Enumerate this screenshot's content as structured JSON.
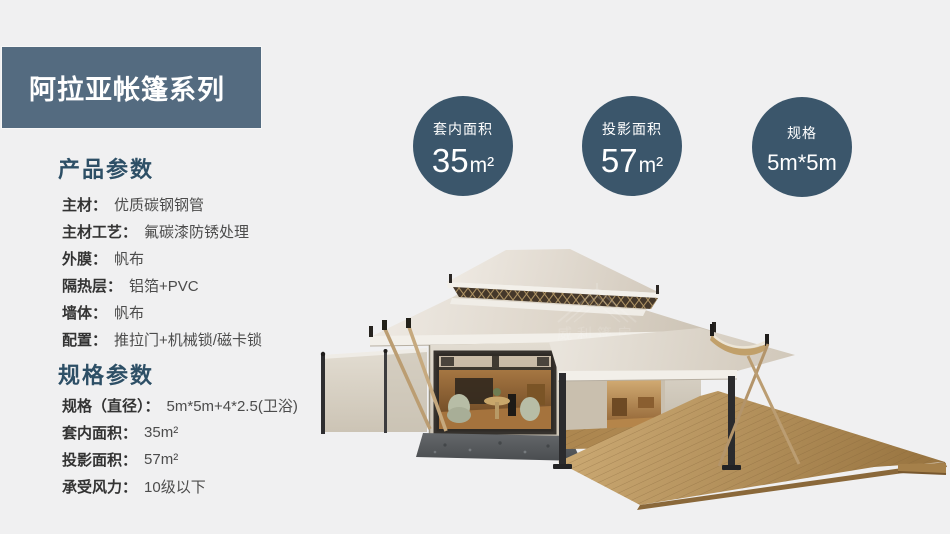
{
  "header": {
    "title": "阿拉亚帐篷系列"
  },
  "stat_circles": [
    {
      "label": "套内面积",
      "value": "35",
      "unit": "m²"
    },
    {
      "label": "投影面积",
      "value": "57",
      "unit": "m²"
    },
    {
      "label": "规格",
      "value": "5m*5m",
      "unit": ""
    }
  ],
  "product_params": {
    "heading": "产品参数",
    "rows": [
      {
        "label": "主材：",
        "value": "优质碳钢钢管"
      },
      {
        "label": "主材工艺：",
        "value": "氟碳漆防锈处理"
      },
      {
        "label": "外膜：",
        "value": "帆布"
      },
      {
        "label": "隔热层：",
        "value": "铝箔+PVC"
      },
      {
        "label": "墙体：",
        "value": "帆布"
      },
      {
        "label": "配置：",
        "value": "推拉门+机械锁/磁卡锁"
      }
    ]
  },
  "spec_params": {
    "heading": "规格参数",
    "rows": [
      {
        "label": "规格（直径）：",
        "value": "5m*5m+4*2.5(卫浴)"
      },
      {
        "label": "套内面积：",
        "value": "35m²"
      },
      {
        "label": "投影面积：",
        "value": "57m²"
      },
      {
        "label": "承受风力：",
        "value": "10级以下"
      }
    ]
  },
  "watermark": {
    "cn": "威利篷房",
    "en": "WELL TENT"
  },
  "colors": {
    "page_bg": "#f0f0f1",
    "header_bg": "#546b80",
    "circle_bg": "#3b566b",
    "heading_text": "#2d4f66",
    "roof_canvas": "#ddd5c9",
    "deck_wood": "#b08a52"
  }
}
